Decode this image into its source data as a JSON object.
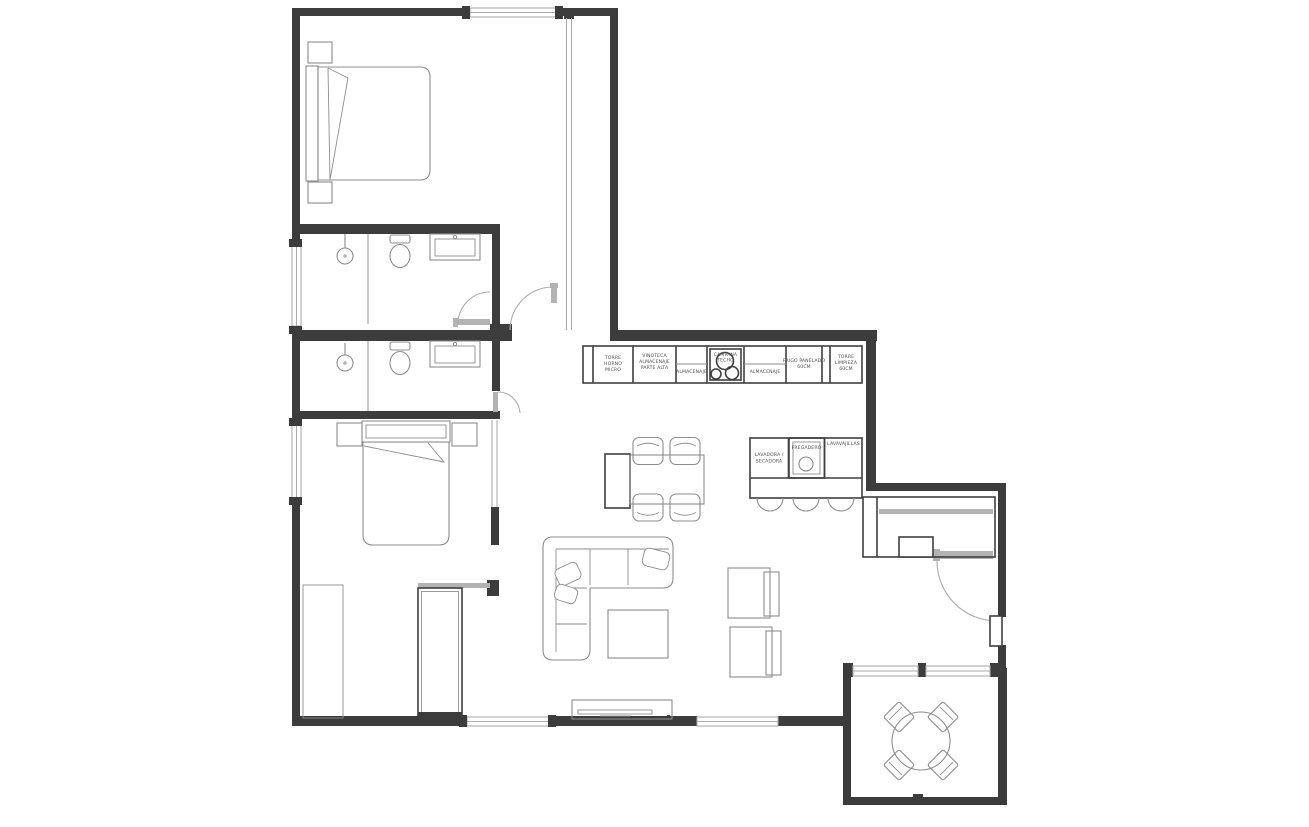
{
  "palette": {
    "background": "#ffffff",
    "wall": "#3c3c3c",
    "furniture_line": "#8d8d8d",
    "dark_line": "#3f3f3f",
    "glass_line": "#ababab",
    "label_text": "#4f4f4f"
  },
  "plan": {
    "kitchen_wall_units": [
      {
        "name": "tall-unit-oven-micro",
        "lines": [
          "TORRE",
          "HORNO",
          "MICRO"
        ]
      },
      {
        "name": "wine-storage-upper",
        "lines": [
          "VINOTECA",
          "ALMACENAJE",
          "PARTE ALTA"
        ]
      },
      {
        "name": "storage-1",
        "lines": [
          "ALMACENAJE"
        ]
      },
      {
        "name": "ceiling-hood-hob",
        "lines": [
          "CAMPANA",
          "TECHO"
        ]
      },
      {
        "name": "storage-2",
        "lines": [
          "ALMACENAJE"
        ]
      },
      {
        "name": "paneled-fridge",
        "lines": [
          "FRIGO PANELADO",
          "60CM"
        ]
      },
      {
        "name": "cleaning-tall-unit",
        "lines": [
          "TORRE",
          "LIMPIEZA",
          "60CM"
        ]
      }
    ],
    "island_units": [
      {
        "name": "washer-dryer",
        "lines": [
          "LAVADORA /",
          "SECADORA"
        ]
      },
      {
        "name": "sink",
        "lines": [
          "FREGADERO"
        ]
      },
      {
        "name": "dishwasher",
        "lines": [
          "LAVAVAJILLAS"
        ]
      }
    ]
  }
}
